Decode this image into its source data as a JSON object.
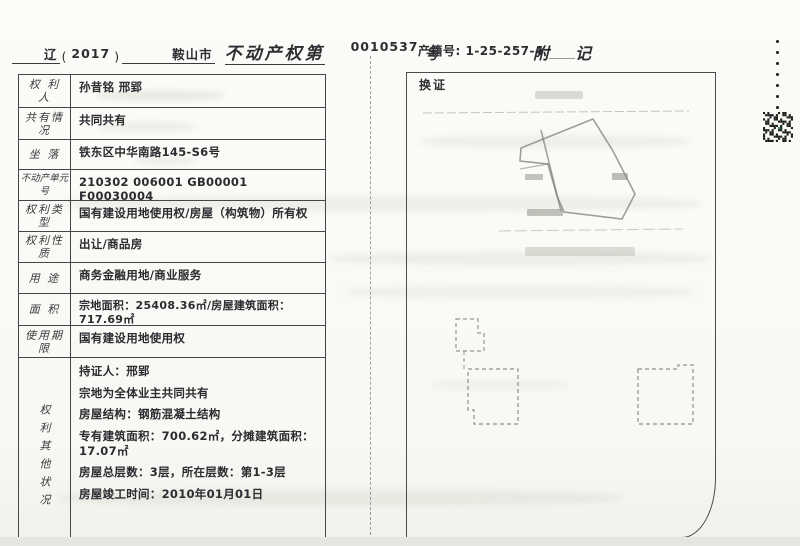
{
  "header_left": {
    "region": "辽",
    "bracket_open": "(",
    "year": "2017",
    "bracket_close": ")",
    "city": "鞍山市",
    "title": "不动产权第",
    "serial": "0010537",
    "suffix": "号"
  },
  "header_right": {
    "property_code": "产籍号: 1-25-257-4",
    "annex_char1": "附",
    "annex_char2": "记"
  },
  "annex": {
    "box_label": "换证"
  },
  "table": {
    "rows": [
      {
        "label": "权 利 人",
        "value": "孙昔铭 邢郢"
      },
      {
        "label": "共有情况",
        "value": "共同共有"
      },
      {
        "label": "坐  落",
        "value": "铁东区中华南路145-S6号"
      },
      {
        "label": "不动产单元号",
        "value": "210302 006001 GB00001 F00030004"
      },
      {
        "label": "权利类型",
        "value": "国有建设用地使用权/房屋（构筑物）所有权"
      },
      {
        "label": "权利性质",
        "value": "出让/商品房"
      },
      {
        "label": "用  途",
        "value": "商务金融用地/商业服务"
      },
      {
        "label": "面  积",
        "value": "宗地面积：25408.36㎡/房屋建筑面积：717.69㎡"
      },
      {
        "label": "使用期限",
        "value": "国有建设用地使用权"
      }
    ],
    "other_label": "权利其他状况",
    "other_lines": [
      "持证人：邢郢",
      "宗地为全体业主共同共有",
      "房屋结构：钢筋混凝土结构",
      "专有建筑面积：700.62㎡，分摊建筑面积：17.07㎡",
      "房屋总层数：3层，所在层数：第1-3层",
      "房屋竣工时间：2010年01月01日"
    ]
  },
  "colors": {
    "paper": "#fbfbf8",
    "ink": "#2e2e32",
    "table_border": "#44444a",
    "faint_sketch": "#8a8a84",
    "qr_green": "#2e8b57"
  }
}
